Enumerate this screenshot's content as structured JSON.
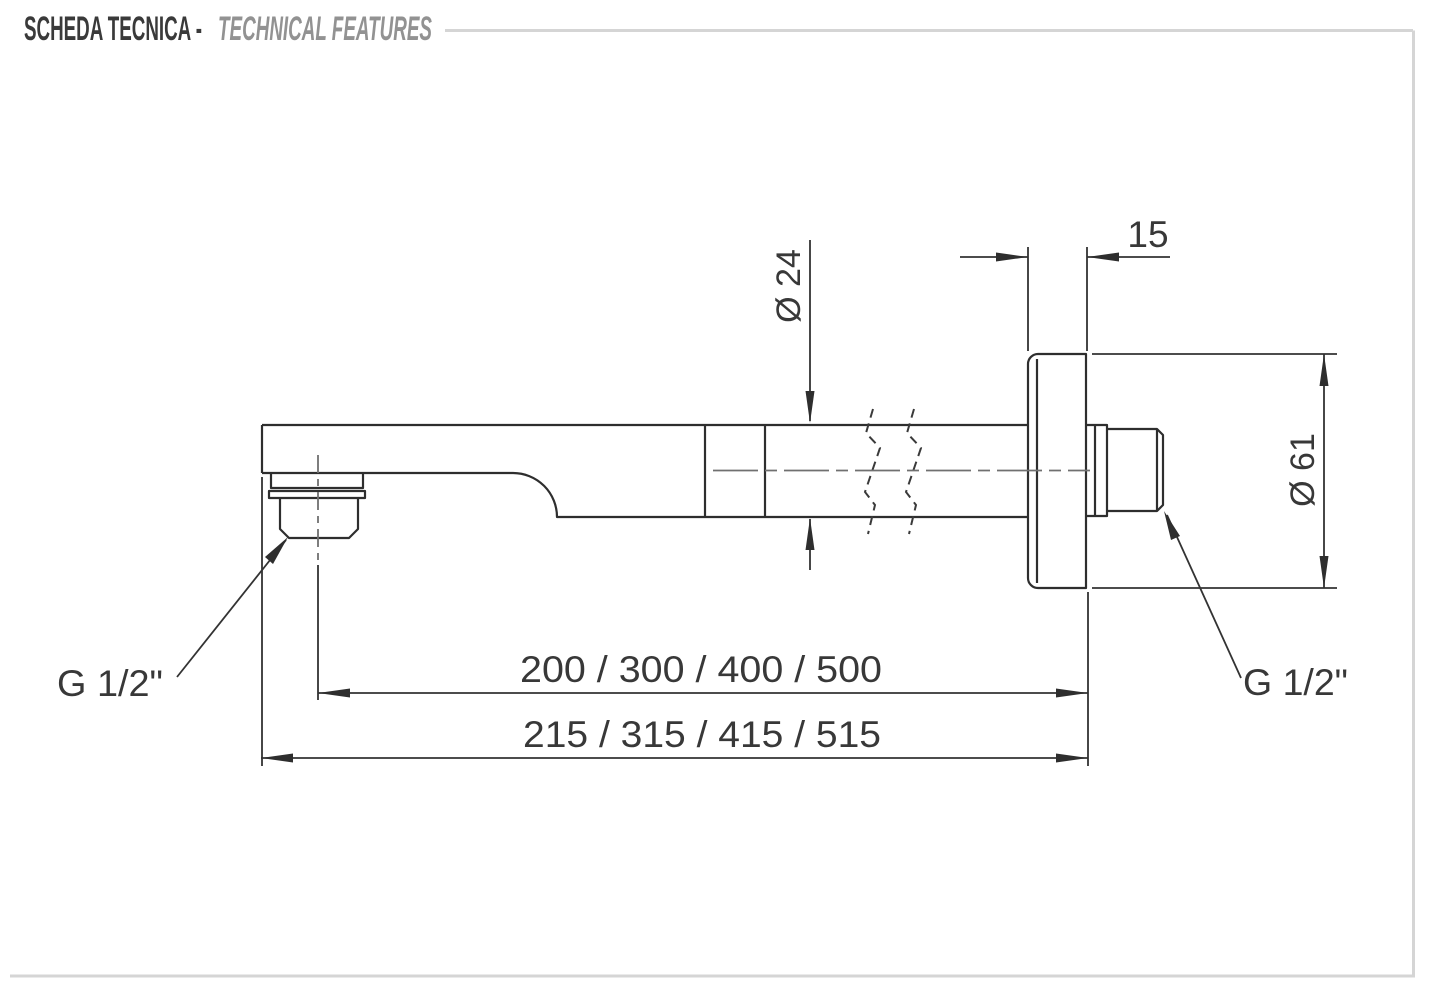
{
  "header": {
    "title_primary": "SCHEDA TECNICA -",
    "title_secondary": "TECHNICAL FEATURES"
  },
  "drawing": {
    "dimensions": {
      "flange_thickness": "15",
      "arm_diameter": "Ø 24",
      "flange_diameter": "Ø 61",
      "arm_lengths": "200 / 300 / 400 / 500",
      "overall_lengths": "215 / 315 / 415 / 515"
    },
    "labels": {
      "outlet_thread": "G 1/2\"",
      "wall_thread": "G 1/2\""
    },
    "colors": {
      "outline": "#2e2e2e",
      "centerline": "#707070",
      "frame": "#d5d5d5",
      "title_primary": "#3a3a3a",
      "title_secondary": "#929292",
      "background": "#ffffff"
    }
  }
}
